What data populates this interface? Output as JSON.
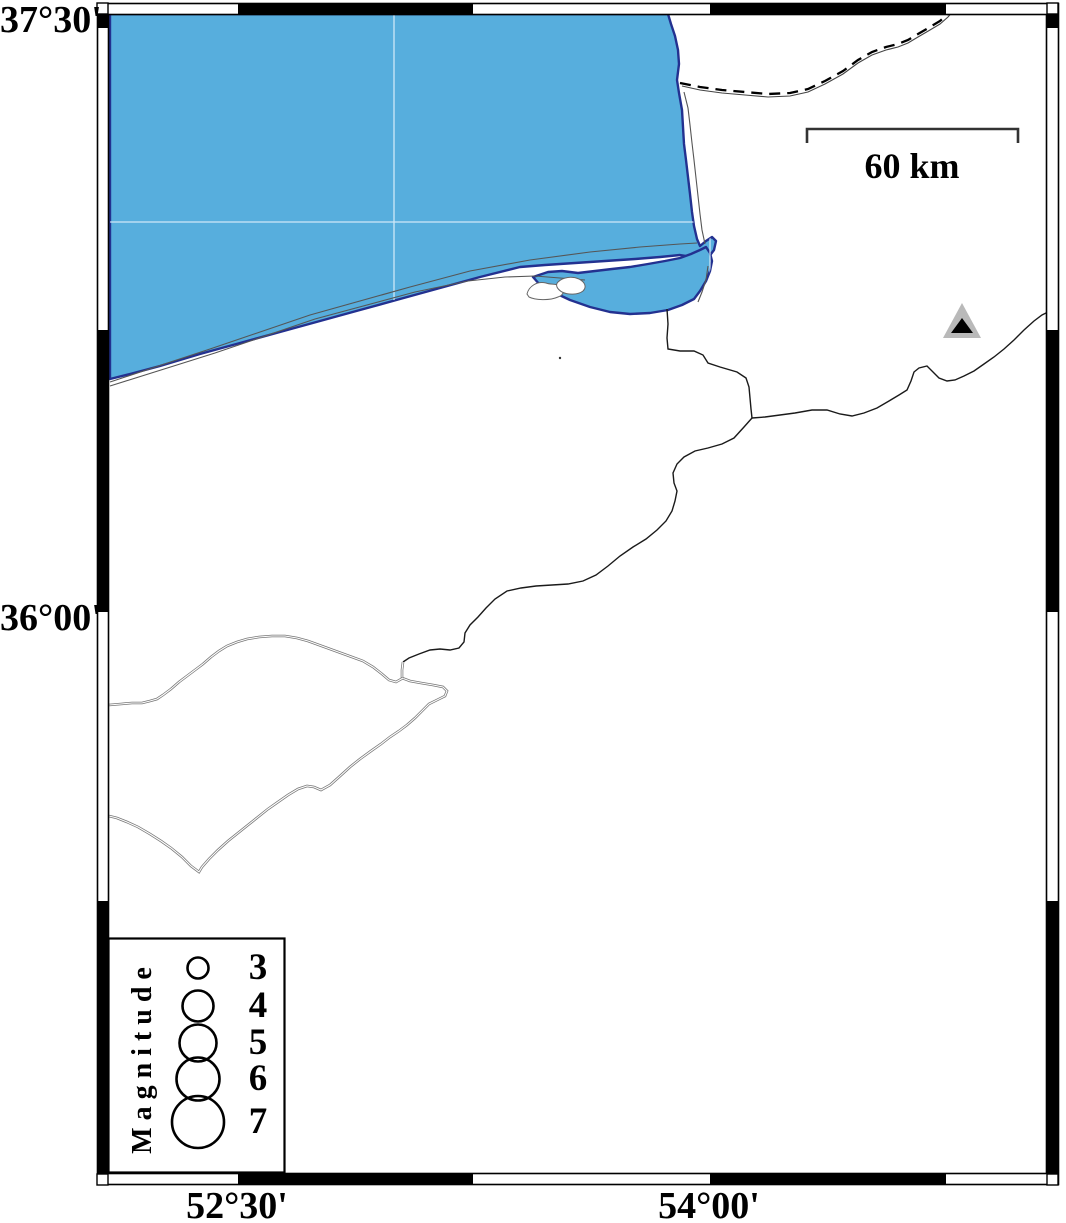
{
  "figure": {
    "type": "seismicity-map",
    "description": "GMT-style map of the SE Caspian Sea / Gorgan Bay region with fancy frame, scale bar, station triangle and magnitude legend"
  },
  "axis_labels": {
    "lat_top": "37°30'",
    "lat_mid": "36°00'",
    "lon_left": "52°30'",
    "lon_right": "54°00'"
  },
  "scale_bar": {
    "label": "60 km"
  },
  "legend": {
    "title": "Magnitude",
    "items": [
      {
        "label": "3",
        "r": 10.5
      },
      {
        "label": "4",
        "r": 15.5
      },
      {
        "label": "5",
        "r": 18.5
      },
      {
        "label": "6",
        "r": 21.5
      },
      {
        "label": "7",
        "r": 26
      }
    ]
  },
  "markers": {
    "station": {
      "shape": "double-triangle",
      "description": "gray triangle with black core, NE quadrant"
    }
  },
  "colors": {
    "sea": "#57AEDD",
    "coast_outline": "#233190",
    "land": "#ffffff",
    "frame": "#000000",
    "thin_line": "#555555",
    "river": "#1a1a1a",
    "grid": "#dceefb",
    "station_fill": "#b9b9b9",
    "station_core": "#000000"
  }
}
